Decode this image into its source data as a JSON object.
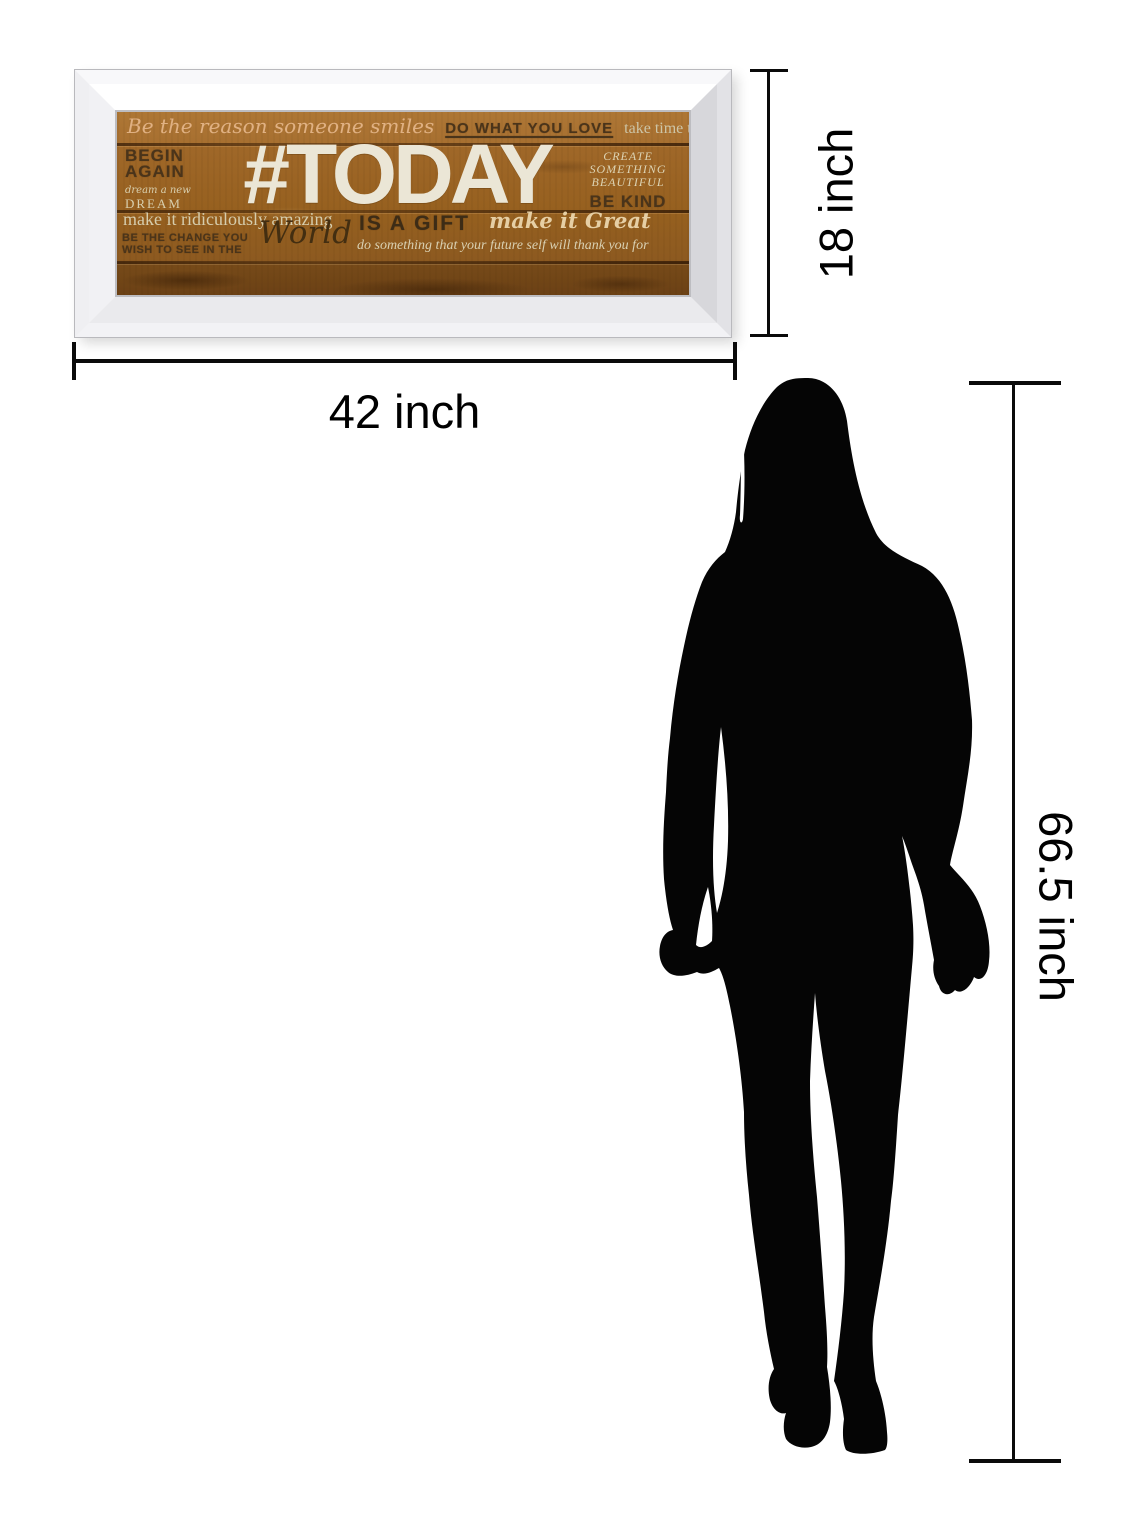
{
  "artwork": {
    "plaque": {
      "line1": {
        "script": "Be the reason someone smiles",
        "bold": "DO WHAT YOU LOVE",
        "light": "take time to care"
      },
      "left_column": {
        "line1": "BEGIN",
        "line2": "AGAIN",
        "line3": "dream a new",
        "line4": "DREAM"
      },
      "headline": "#TODAY",
      "right_column": {
        "line1": "CREATE",
        "line2": "SOMETHING",
        "line3": "BEAUTIFUL",
        "line4": "BE KIND"
      },
      "line3": {
        "light": "make it ridiculously amazing",
        "bold": "IS A GIFT",
        "script": "make it Great"
      },
      "line4": {
        "bold_line1": "BE THE CHANGE YOU",
        "bold_line2": "WISH TO SEE IN THE",
        "script": "World",
        "light": "do something that your future self will thank you for"
      }
    },
    "colors": {
      "wood": "#9a6426",
      "frame_mirror": "#ededf0",
      "dark_text": "#4a341a",
      "cream_text": "#d8cfae",
      "headline_text": "#ebe6d6",
      "script_tan": "#e0b183"
    }
  },
  "dimensions": {
    "frame_width_label": "42 inch",
    "frame_height_label": "18 inch",
    "figure_height_label": "66.5 inch",
    "line_color": "#000000"
  },
  "figure": {
    "type": "standing-woman-silhouette",
    "color": "#000000"
  }
}
